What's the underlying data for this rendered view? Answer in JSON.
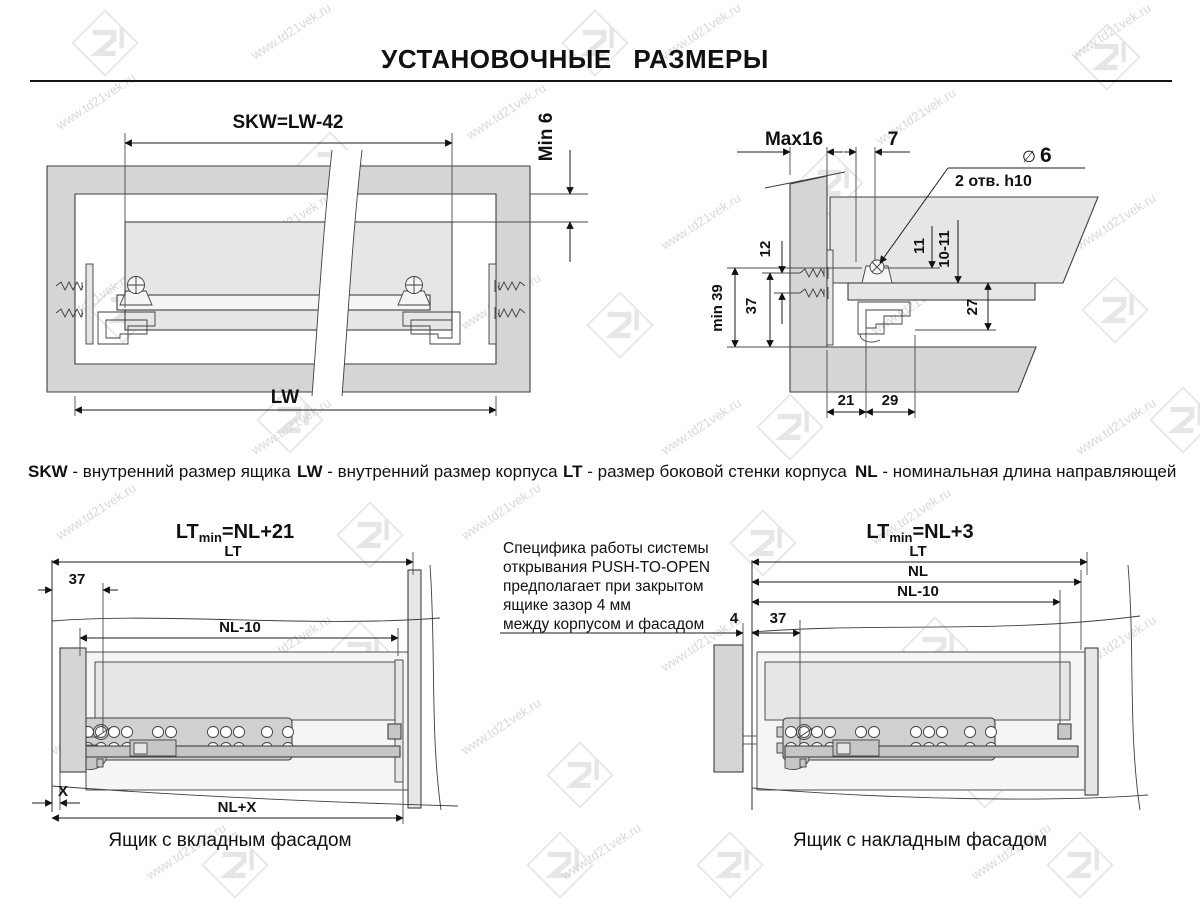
{
  "title": "УСТАНОВОЧНЫЕ РАЗМЕРЫ",
  "watermark": {
    "text": "www.td21vek.ru"
  },
  "legend": [
    {
      "term": "SKW",
      "def": "- внутренний размер ящика"
    },
    {
      "term": "LW",
      "def": "- внутренний размер корпуса"
    },
    {
      "term": "LT",
      "def": "- размер боковой стенки корпуса"
    },
    {
      "term": "NL",
      "def": "- номинальная длина направляющей"
    }
  ],
  "fig_plan": {
    "dim_skw": "SKW=LW-42",
    "dim_min6": "Min 6",
    "dim_lw": "LW"
  },
  "fig_section": {
    "dim_max16": "Max16",
    "dim_7": "7",
    "hole_dia_symbol": "∅",
    "hole_dia_value": "6",
    "hole_note": "2 отв. h10",
    "dim_12": "12",
    "dim_37": "37",
    "dim_min39": "min 39",
    "dim_11": "11",
    "dim_10_11": "10-11",
    "dim_27": "27",
    "dim_21": "21",
    "dim_29": "29"
  },
  "fig_inset": {
    "formula_prefix": "LT",
    "formula_sub": "min",
    "formula_rest": "=NL+21",
    "dim_lt": "LT",
    "dim_37": "37",
    "dim_nl10": "NL-10",
    "dim_x": "X",
    "dim_nlx": "NL+X",
    "caption": "Ящик с вкладным фасадом"
  },
  "note": {
    "line1": "Специфика работы системы",
    "line2": "открывания PUSH-TO-OPEN",
    "line3": "предполагает при закрытом",
    "line4": "ящике зазор 4 мм",
    "line5": "между корпусом и фасадом"
  },
  "fig_overlay": {
    "formula_prefix": "LT",
    "formula_sub": "min",
    "formula_rest": "=NL+3",
    "dim_lt": "LT",
    "dim_nl": "NL",
    "dim_nl10": "NL-10",
    "dim_4": "4",
    "dim_37": "37",
    "caption": "Ящик с накладным фасадом"
  }
}
